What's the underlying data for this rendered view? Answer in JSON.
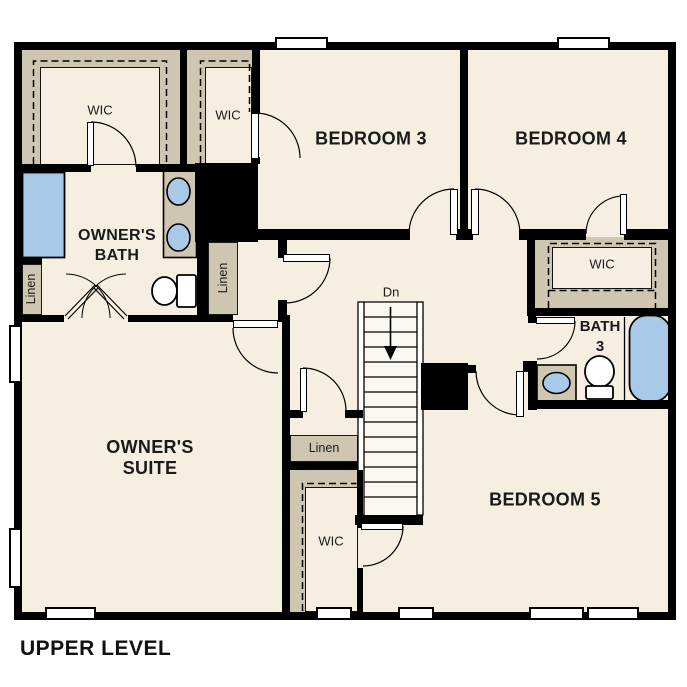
{
  "title": "UPPER LEVEL",
  "palette": {
    "background": "#ffffff",
    "floor": "#f5eee1",
    "closet_floor": "#cfc6b1",
    "wall": "#000000",
    "fixture_blue": "#a9c9e9",
    "stairs": "#fbf8f1",
    "text": "#1a1a1a"
  },
  "rooms": {
    "bedroom3": {
      "label": "BEDROOM 3"
    },
    "bedroom4": {
      "label": "BEDROOM 4"
    },
    "bedroom5": {
      "label": "BEDROOM 5"
    },
    "owners_suite": {
      "line1": "OWNER'S",
      "line2": "SUITE"
    },
    "owners_bath": {
      "line1": "OWNER'S",
      "line2": "BATH"
    },
    "bath3": {
      "line1": "BATH",
      "line2": "3"
    }
  },
  "closets": {
    "owners_wic": {
      "label": "WIC"
    },
    "bedroom3_wic": {
      "label": "WIC"
    },
    "bedroom4_wic": {
      "label": "WIC"
    },
    "bedroom5_wic": {
      "label": "WIC"
    },
    "bath_linen": {
      "label": "Linen"
    },
    "suite_entry_linen": {
      "label": "Linen"
    },
    "hall_linen": {
      "label": "Linen"
    }
  },
  "stairs": {
    "direction_label": "Dn"
  },
  "fixtures": {
    "owners_bath": [
      "shower",
      "double-vanity-sinks",
      "toilet"
    ],
    "bath3": [
      "vanity-sink",
      "toilet",
      "bathtub"
    ]
  }
}
